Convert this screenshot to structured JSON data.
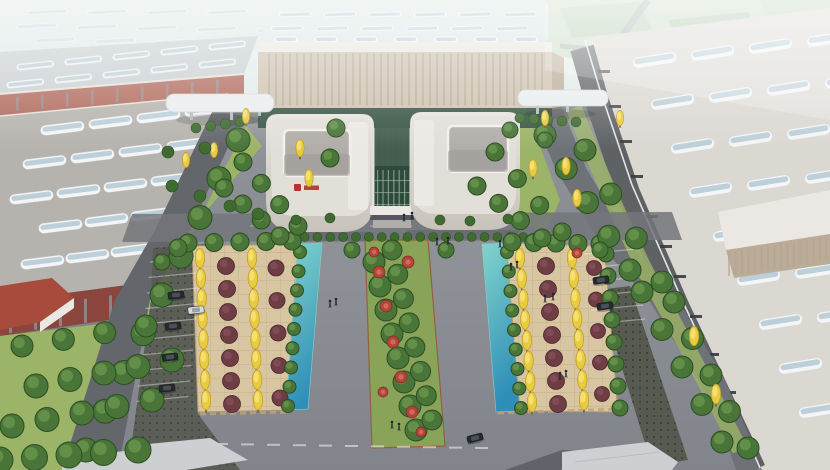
{
  "scene": {
    "kind": "architectural-aerial-rendering",
    "subject": "industrial-campus-birdseye",
    "elements": [
      "factory-halls-with-skylight-roofs",
      "twin-u-shaped-office-buildings",
      "central-glass-atrium",
      "sky-bridges",
      "landscaped-parking-plazas",
      "ginkgo-and-red-leaf-trees",
      "water-channels",
      "green-median-with-flower-beds",
      "roads",
      "parked-cars",
      "pedestrians",
      "distant-hazy-buildings"
    ]
  },
  "logo": {
    "legible": false,
    "color": "#b5352c"
  },
  "palette": {
    "hazeSky": "#e9f2ef",
    "hazeMid": "#dde6e4",
    "groundTop": "#94979c",
    "groundBottom": "#72767c",
    "plazaLight": "#9da0a5",
    "hazeGreenZone": "#c9dac6",
    "hazeBlock1": "#b7cfb3",
    "hazeBlock2": "#aec9ad",
    "hazeBlock3": "#bdd3ba",
    "hazeRoad": "#a3adad",
    "distantRoofBase": "#dde8e6",
    "roofGrayFar": "#c9ced0",
    "roofGrayNear": "#b6b3ae",
    "roofWhiteWarm": "#dbd8d2",
    "skylightFrame": "#f3f5f6",
    "skylightGlass": "#b9ccd6",
    "brick": "#9c5247",
    "brickDark": "#8a463c",
    "brickLight": "#b0685a",
    "windowStrip": "#8d9298",
    "wallSlit": "#383b3f",
    "wallGrayR1": "#5f6265",
    "facadeBeige": "#cdc1af",
    "facadeLine": "#b0a38f",
    "facadeSide": "#bbac97",
    "parapetWhite": "#ebe8e3",
    "glassDark": "#31503f",
    "atriumGlass": "#2d4a3c",
    "glassMullion": "#9cb8a7",
    "uWallLight": "#e7e4df",
    "uWallShade": "#c8c3ba",
    "uRoofTop": "#e2dfd9",
    "courtyard": "#b1aeaa",
    "courtyardShade": "#9c9995",
    "wingLight": "#edebe6",
    "logoRed": "#b5352c",
    "roadAsphalt": "#63666b",
    "roadAsphalt2": "#6e7175",
    "topRoad": "#7f8287",
    "frontRoad": "#73767b",
    "paving": "#d8c6a3",
    "pavingGrid": "#b59a73",
    "curb": "#c2a577",
    "waterLight": "#82d4cb",
    "waterDark": "#2f8fb8",
    "waterEdge": "#8ad0c8",
    "lawn": "#9cb468",
    "lawnDark": "#89a458",
    "medianBorder": "#96603c",
    "treeGreen": "#4a7539",
    "treeGreenDark": "#2c4f22",
    "treeGreenHl": "#74a055",
    "treeYellow": "#e9cb3f",
    "treeYellowDark": "#c2a029",
    "treeYellowHl": "#f6e37c",
    "trunk": "#7a5836",
    "treeRed": "#6e3e44",
    "treeRedDark": "#4a262d",
    "treeRedHl": "#8a5660",
    "hedge": "#3f6b31",
    "flowerRed": "#b2453a",
    "flowerRedDark": "#7d2d27",
    "flowerRedHl": "#d5705a",
    "grassCrete": "#565a50",
    "grassCreteDot": "#3c4038",
    "carDark": "#26292e",
    "carWhite": "#d7dadd",
    "carDarkCabin": "#4a5058",
    "carWhiteCabin": "#9aa0a6",
    "people": "#22252a",
    "white": "#f2f3f4",
    "bridgeRoof": "#eaedef",
    "bridgeLeg": "#b7babd",
    "bldgSmallRoof": "#ccd0d3",
    "bldgSmallRoof2": "#cdd0d2",
    "shadow": "#23262a",
    "redRoofSmall": "#a84a3c"
  },
  "gen": {
    "pills": [
      [
        "#pills-haze",
        26,
        10,
        60,
        0,
        8,
        42,
        6,
        -3,
        0.55
      ],
      [
        "#pills-haze",
        16,
        24,
        60,
        1,
        8,
        42,
        6,
        -3,
        0.5
      ],
      [
        "#pills-haze",
        34,
        38,
        60,
        1,
        8,
        42,
        6,
        -3,
        0.45
      ],
      [
        "#pills-leftfar",
        208,
        44,
        -48,
        5,
        5,
        38,
        7,
        -6,
        0.9
      ],
      [
        "#pills-leftfar",
        198,
        62,
        -48,
        5,
        5,
        38,
        7,
        -6,
        0.9
      ],
      [
        "#pills-leftnear",
        184,
        108,
        -48,
        6,
        4,
        44,
        10,
        -7,
        1
      ],
      [
        "#pills-leftnear",
        166,
        142,
        -48,
        6,
        4,
        44,
        10,
        -7,
        1
      ],
      [
        "#pills-leftnear",
        150,
        177,
        -47,
        6,
        4,
        44,
        10,
        -7,
        1
      ],
      [
        "#pills-leftnear",
        130,
        212,
        -46,
        6,
        3,
        44,
        10,
        -7,
        1
      ],
      [
        "#pills-leftnear",
        110,
        248,
        -45,
        6,
        3,
        44,
        10,
        -7,
        1
      ],
      [
        "#pills-back",
        278,
        12,
        45,
        0,
        6,
        34,
        6,
        -2,
        0.85
      ],
      [
        "#pills-back",
        270,
        26,
        45,
        0,
        6,
        34,
        6,
        -2,
        0.85
      ],
      [
        "#pills-vents",
        274,
        36,
        40,
        0,
        7,
        24,
        7,
        0,
        1
      ],
      [
        "#pills-r1",
        632,
        58,
        58,
        -7,
        4,
        44,
        11,
        -9,
        1
      ],
      [
        "#pills-r1",
        650,
        100,
        58,
        -7,
        4,
        44,
        11,
        -9,
        1
      ],
      [
        "#pills-r1",
        670,
        144,
        58,
        -7,
        3,
        44,
        11,
        -9,
        1
      ],
      [
        "#pills-r1",
        688,
        188,
        58,
        -7,
        3,
        44,
        11,
        -9,
        1
      ],
      [
        "#pills-r1",
        712,
        232,
        58,
        -7,
        3,
        44,
        11,
        -9,
        1
      ],
      [
        "#pills-r1",
        736,
        276,
        58,
        -7,
        3,
        44,
        11,
        -9,
        1
      ],
      [
        "#pills-r1",
        758,
        320,
        58,
        -7,
        3,
        44,
        11,
        -9,
        1
      ],
      [
        "#pills-r1",
        778,
        364,
        58,
        -7,
        2,
        44,
        11,
        -9,
        1
      ],
      [
        "#pills-r1",
        798,
        408,
        58,
        -7,
        2,
        44,
        11,
        -9,
        1
      ]
    ],
    "bars": [
      [
        "#stripes-facade",
        268,
        53,
        7,
        0,
        40,
        2,
        52,
        "facadeLine",
        0.65
      ],
      [
        "#stripes-leftwall",
        216,
        102,
        -11.3,
        30,
        7,
        3,
        22,
        "windowStrip",
        0.85
      ],
      [
        "#stripes-leftfront",
        134,
        292,
        -25,
        3.4,
        6,
        3,
        24,
        "windowStrip",
        0.8
      ],
      [
        "#stripes-bandB",
        16,
        97,
        25,
        -2.1,
        9,
        2.5,
        14,
        "windowStrip",
        0.7
      ],
      [
        "#stripes-r1",
        598,
        70,
        11,
        35,
        4,
        12,
        3,
        "wallSlit",
        0.9
      ],
      [
        "#stripes-r1",
        646,
        215,
        14,
        30,
        3,
        12,
        3,
        "wallSlit",
        0.9
      ],
      [
        "#stripes-r1",
        690,
        315,
        17,
        38,
        3,
        12,
        3,
        "wallSlit",
        0.9
      ],
      [
        "#stripes-clerestory",
        728,
        252,
        6.5,
        -1,
        16,
        2,
        24,
        "facadeLine",
        0.6
      ],
      [
        "#stripes-atrium",
        377,
        170,
        5.4,
        0,
        7,
        1.2,
        38,
        "glassMullion",
        0.7
      ],
      [
        "#stripes-atrium",
        375,
        180,
        0,
        12,
        3,
        36,
        1.1,
        "glassMullion",
        0.6
      ],
      [
        "#stripes-backglass",
        376,
        132,
        5.6,
        0,
        6,
        1,
        32,
        "glassMullion",
        0.5
      ]
    ],
    "lines": [
      [
        "#lines-stall-left",
        150,
        262,
        -1.5,
        15.5,
        10,
        52,
        -5,
        "white",
        0.4,
        1.2
      ],
      [
        "#lines-stall-right",
        584,
        254,
        1.8,
        14,
        6,
        52,
        -5,
        "white",
        0.4,
        1.2
      ],
      [
        "#lines-bottom-dashes",
        215,
        444,
        26,
        0.4,
        11,
        13,
        0,
        "white",
        0.55,
        2
      ],
      [
        "#lines-front-dashes",
        250,
        226,
        30,
        0,
        8,
        12,
        0,
        "white",
        0.3,
        1.5
      ]
    ]
  },
  "veg": {
    "rows": [
      [
        "green",
        238,
        140,
        86,
        450,
        9,
        12
      ],
      [
        "green",
        22,
        346,
        146,
        326,
        4,
        11
      ],
      [
        "green",
        36,
        386,
        172,
        360,
        5,
        12
      ],
      [
        "green",
        12,
        426,
        152,
        400,
        5,
        12
      ],
      [
        "green",
        0,
        460,
        138,
        450,
        5,
        13
      ],
      [
        "hedge",
        266,
        237,
        536,
        237,
        22,
        4.5
      ],
      [
        "green",
        374,
        262,
        416,
        430,
        8,
        11
      ],
      [
        "green",
        392,
        250,
        432,
        420,
        8,
        10
      ],
      [
        "ginkgo",
        200,
        258,
        206,
        400,
        8,
        9
      ],
      [
        "red",
        226,
        266,
        232,
        404,
        7,
        8.5
      ],
      [
        "ginkgo",
        252,
        258,
        258,
        400,
        8,
        9
      ],
      [
        "red",
        276,
        268,
        280,
        398,
        5,
        8
      ],
      [
        "green",
        300,
        252,
        288,
        406,
        9,
        6.5
      ],
      [
        "green",
        188,
        243,
        292,
        241,
        5,
        9
      ],
      [
        "green",
        507,
        252,
        521,
        408,
        9,
        6.5
      ],
      [
        "ginkgo",
        520,
        258,
        532,
        402,
        8,
        9
      ],
      [
        "red",
        546,
        266,
        558,
        404,
        7,
        8.5
      ],
      [
        "ginkgo",
        572,
        258,
        584,
        400,
        8,
        9
      ],
      [
        "red",
        594,
        268,
        602,
        394,
        5,
        7.5
      ],
      [
        "green",
        606,
        254,
        620,
        408,
        8,
        8
      ],
      [
        "green",
        512,
        242,
        600,
        244,
        5,
        9
      ],
      [
        "green",
        545,
        135,
        630,
        270,
        5,
        11
      ],
      [
        "green",
        642,
        292,
        722,
        442,
        5,
        11
      ],
      [
        "green",
        585,
        150,
        662,
        282,
        4,
        11
      ],
      [
        "green",
        674,
        302,
        748,
        448,
        5,
        11
      ],
      [
        "green",
        495,
        152,
        562,
        232,
        4,
        9
      ],
      [
        "green",
        477,
        186,
        542,
        238,
        4,
        9
      ],
      [
        "green",
        243,
        162,
        298,
        226,
        4,
        9
      ],
      [
        "green",
        224,
        188,
        280,
        236,
        4,
        9
      ],
      [
        "hedge",
        520,
        118,
        576,
        122,
        5,
        5
      ],
      [
        "hedge",
        196,
        128,
        240,
        122,
        4,
        5
      ]
    ],
    "singles": [
      [
        "ginkgo",
        300,
        148,
        8
      ],
      [
        "ginkgo",
        309,
        178,
        8
      ],
      [
        "ginkgo",
        533,
        168,
        8
      ],
      [
        "ginkgo",
        566,
        166,
        8
      ],
      [
        "ginkgo",
        577,
        198,
        8
      ],
      [
        "ginkgo",
        620,
        118,
        7
      ],
      [
        "ginkgo",
        694,
        336,
        9
      ],
      [
        "ginkgo",
        716,
        394,
        9
      ],
      [
        "ginkgo",
        246,
        116,
        7
      ],
      [
        "ginkgo",
        545,
        118,
        7
      ],
      [
        "ginkgo",
        186,
        160,
        7
      ],
      [
        "ginkgo",
        214,
        150,
        7
      ],
      [
        "green",
        336,
        128,
        9
      ],
      [
        "green",
        330,
        158,
        9
      ],
      [
        "green",
        352,
        250,
        8
      ],
      [
        "green",
        446,
        250,
        8
      ],
      [
        "green",
        600,
        250,
        8
      ],
      [
        "green",
        178,
        248,
        9
      ],
      [
        "green",
        162,
        262,
        8
      ],
      [
        "green",
        510,
        130,
        8
      ],
      [
        "green",
        545,
        140,
        8
      ],
      [
        "hedge",
        168,
        152,
        6
      ],
      [
        "hedge",
        205,
        148,
        6
      ],
      [
        "hedge",
        172,
        186,
        6
      ],
      [
        "hedge",
        200,
        196,
        6
      ],
      [
        "hedge",
        230,
        206,
        6
      ],
      [
        "hedge",
        258,
        214,
        6
      ],
      [
        "hedge",
        296,
        220,
        5
      ],
      [
        "hedge",
        330,
        218,
        5
      ],
      [
        "hedge",
        440,
        220,
        5
      ],
      [
        "hedge",
        470,
        221,
        5
      ],
      [
        "hedge",
        508,
        219,
        5
      ]
    ]
  },
  "flowers": [
    [
      379,
      272,
      6
    ],
    [
      386,
      306,
      6
    ],
    [
      393,
      342,
      6
    ],
    [
      401,
      377,
      6
    ],
    [
      412,
      412,
      6
    ],
    [
      421,
      432,
      5
    ],
    [
      383,
      392,
      5
    ],
    [
      374,
      252,
      5
    ],
    [
      408,
      262,
      6
    ],
    [
      577,
      253,
      5
    ]
  ],
  "cars": [
    [
      176,
      295,
      -6,
      "dark"
    ],
    [
      173,
      326,
      -6,
      "dark"
    ],
    [
      170,
      357,
      -6,
      "dark"
    ],
    [
      167,
      388,
      -6,
      "dark"
    ],
    [
      475,
      438,
      -15,
      "dark"
    ],
    [
      601,
      280,
      -8,
      "dark"
    ],
    [
      605,
      306,
      -8,
      "dark"
    ],
    [
      196,
      310,
      -6,
      "white"
    ]
  ],
  "people": [
    [
      437,
      241
    ],
    [
      448,
      240
    ],
    [
      500,
      243
    ],
    [
      511,
      266
    ],
    [
      517,
      264
    ],
    [
      545,
      298
    ],
    [
      553,
      296
    ],
    [
      392,
      424
    ],
    [
      399,
      426
    ],
    [
      336,
      301
    ],
    [
      330,
      303
    ],
    [
      404,
      217
    ],
    [
      412,
      215
    ],
    [
      560,
      375
    ],
    [
      566,
      373
    ]
  ]
}
